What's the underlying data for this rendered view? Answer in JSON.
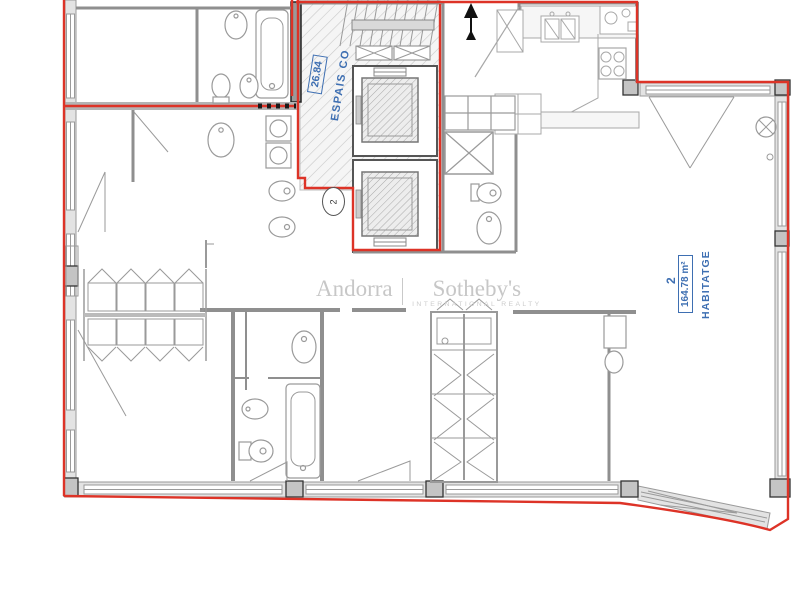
{
  "document": {
    "type": "apartment floor plan"
  },
  "labels": {
    "common_area": {
      "area_value": "26.84",
      "name": "ESPAIS CO"
    },
    "unit_circle": {
      "number": "2"
    },
    "dwelling": {
      "number": "2",
      "area": "164.78 m²",
      "name": "HABITATGE"
    }
  },
  "watermark": {
    "left": "Andorra",
    "divider": "|",
    "right": "Sotheby's",
    "subtitle": "INTERNATIONAL REALTY"
  },
  "colors": {
    "boundary_red": "#dd3327",
    "label_blue": "#3e6fb2",
    "wall_gray": "#8f8f8f",
    "watermark_gray": "#c7c7c7"
  }
}
